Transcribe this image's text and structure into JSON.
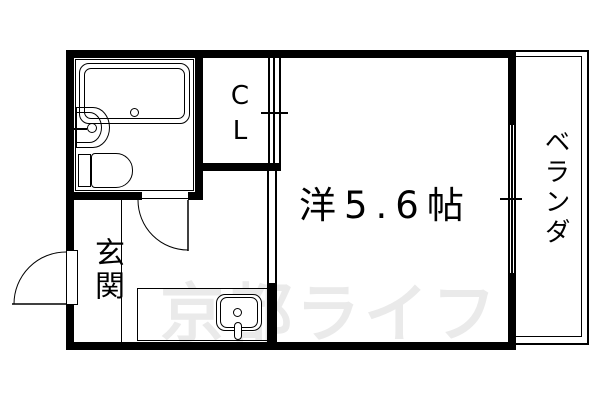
{
  "plan": {
    "rooms": {
      "main_room": {
        "label": "洋5.6帖"
      },
      "closet": {
        "label": "CL"
      },
      "entrance": {
        "label": "玄関"
      },
      "balcony": {
        "label": "ベランダ"
      }
    }
  },
  "watermark": {
    "text": "京都ライフ",
    "color": "#eaeaea"
  },
  "colors": {
    "line": "#000000",
    "background": "#ffffff"
  }
}
